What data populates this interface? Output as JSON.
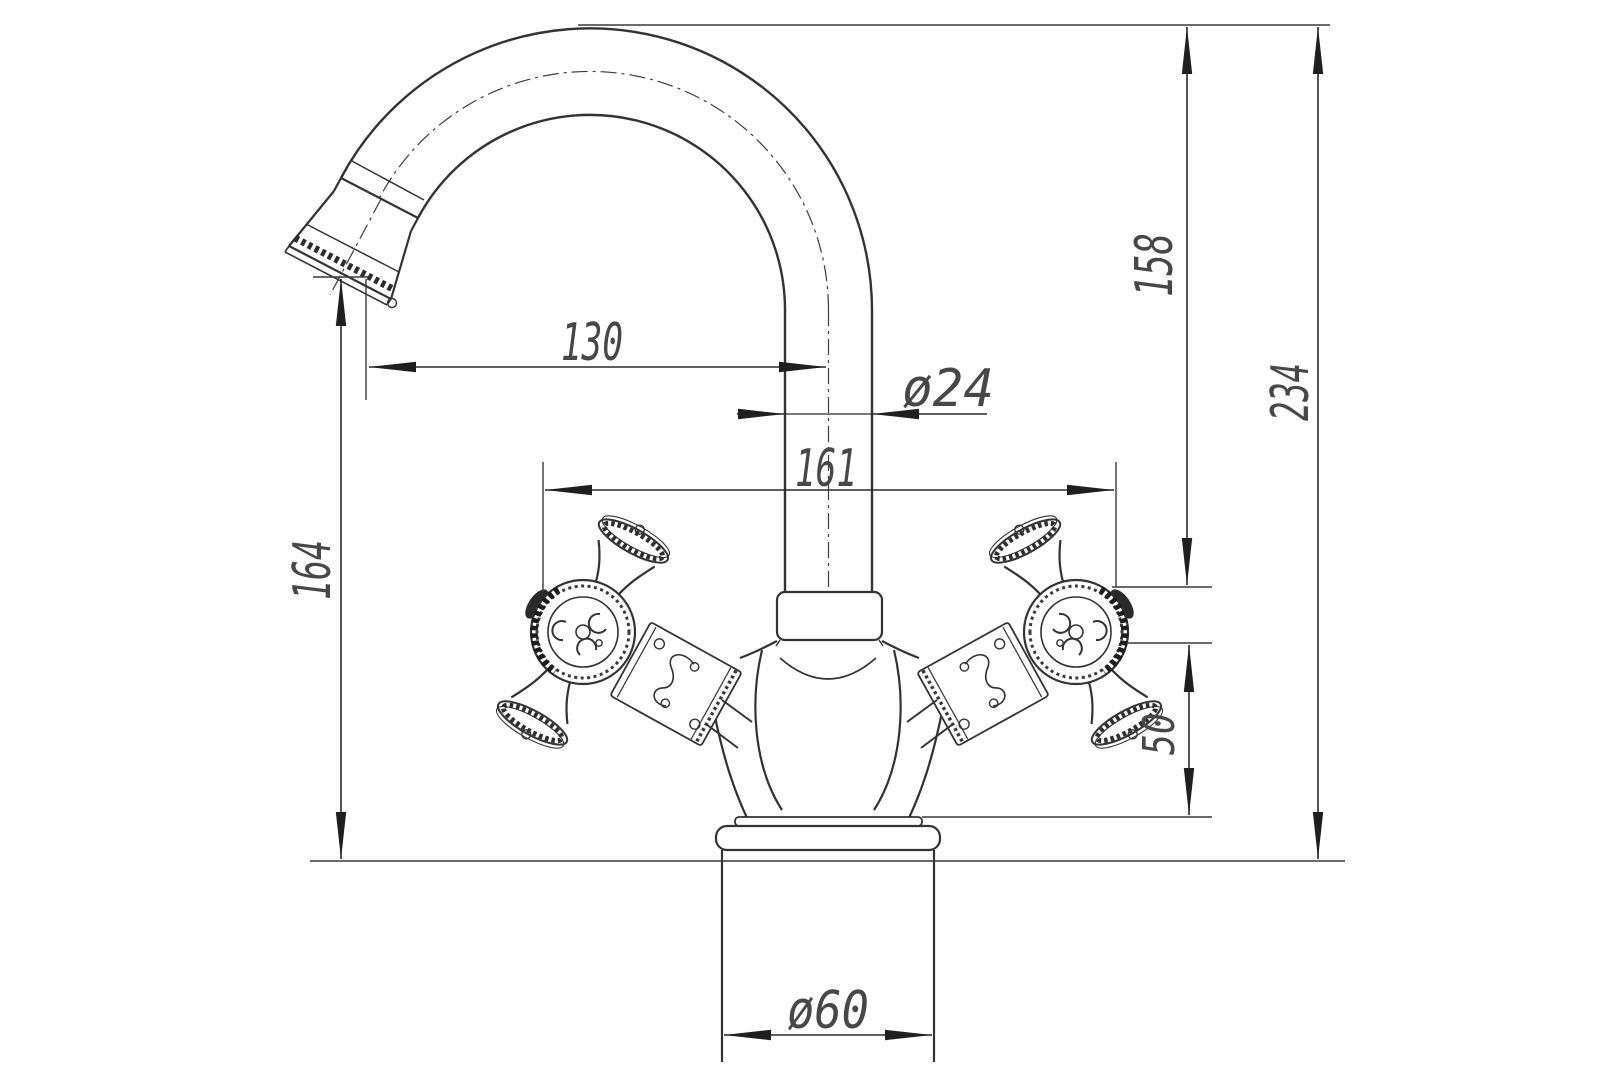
{
  "drawing": {
    "title": "faucet-technical-drawing",
    "background": "#ffffff",
    "line_color": "#333333",
    "arrow_color": "#1f1f1f",
    "text_color": "#474747",
    "dimensions": {
      "spout_reach": "130",
      "spout_tube_diameter": "ø24",
      "handle_span": "161",
      "spout_top_to_handle_top": "158",
      "overall_height": "234",
      "spout_outlet_height": "164",
      "handle_center_to_base": "50",
      "base_diameter": "ø60"
    }
  }
}
